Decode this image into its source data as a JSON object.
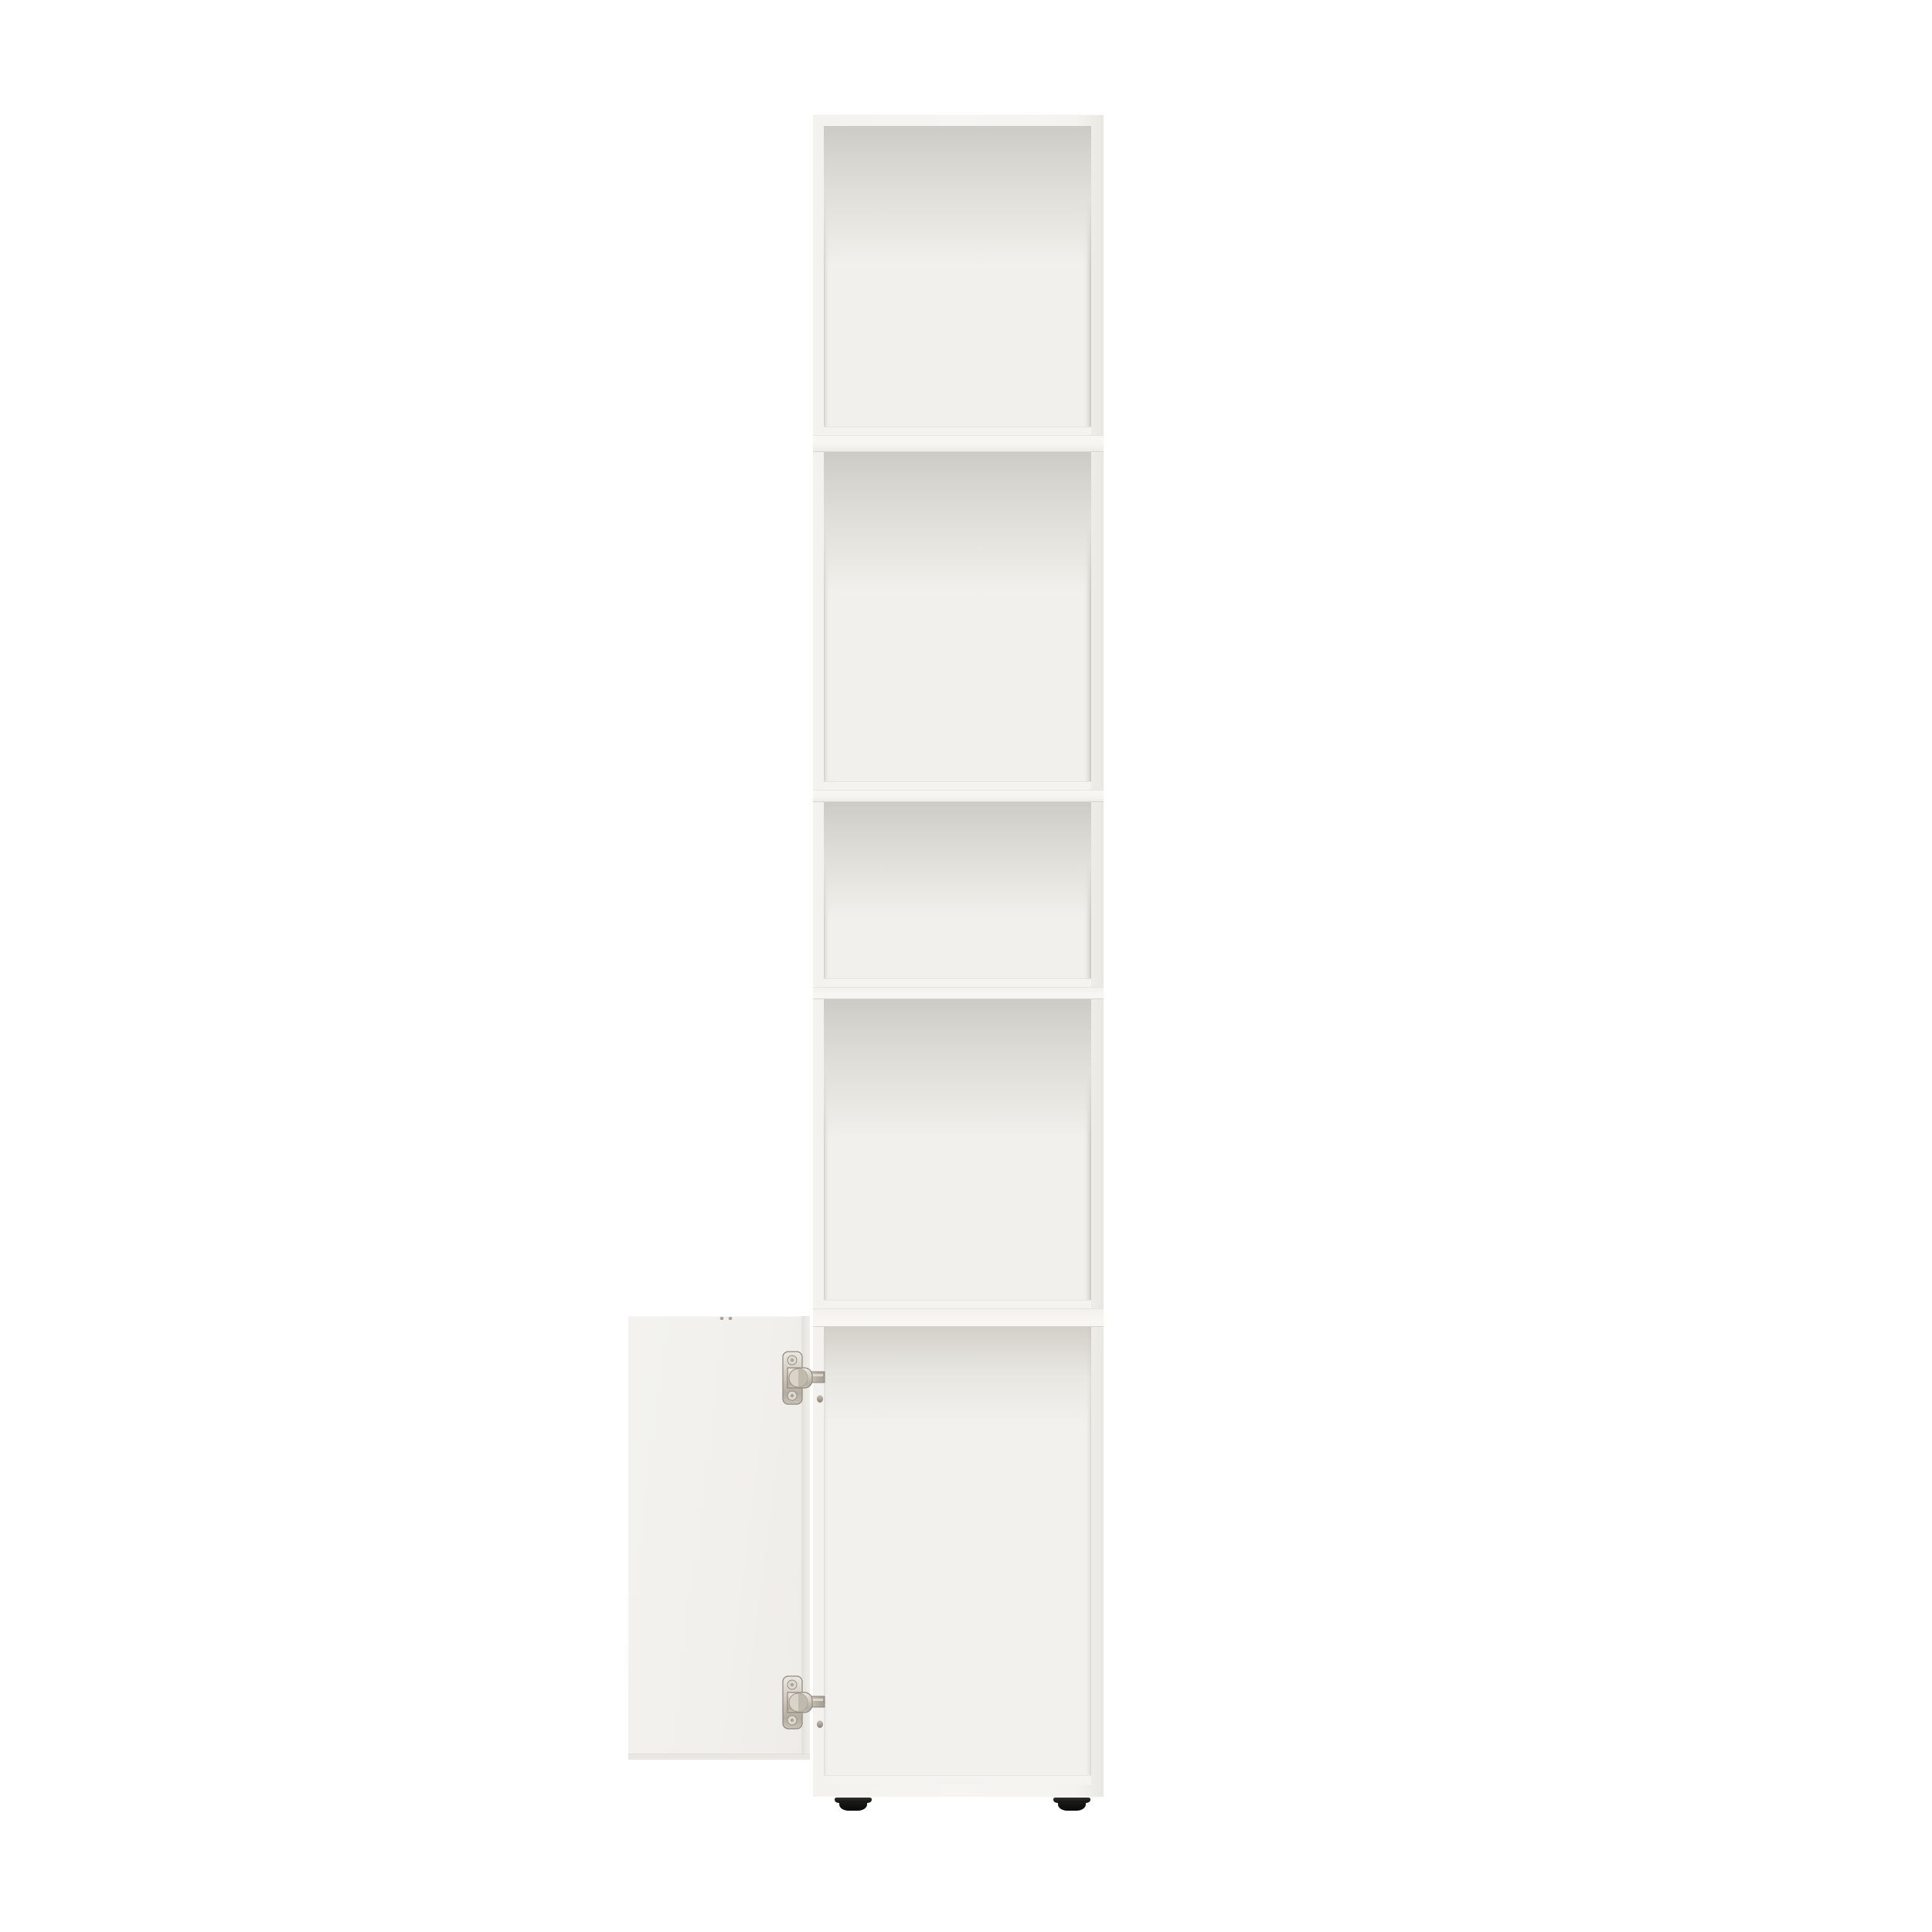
{
  "meta": {
    "subject": "Tall narrow white bookcase with four open compartments, an open bottom cabinet door with two nickel concealed hinges, standing on two black adjustable feet",
    "visible_text": "none"
  },
  "scene": {
    "background_color": "#ffffff"
  },
  "cabinet": {
    "finish": "matte white",
    "body_color": "#f5f4f1",
    "edge_shade_color": "#eae8e3",
    "interior_back_color": "#f1f0ec",
    "interior_shadow_color": "#cdcbc5",
    "open_compartment_count": 4,
    "divider_count": 3,
    "compartments": [
      {
        "label": "compartment-1",
        "relative_height": "tall"
      },
      {
        "label": "compartment-2",
        "relative_height": "tallest"
      },
      {
        "label": "compartment-3",
        "relative_height": "short"
      },
      {
        "label": "compartment-4",
        "relative_height": "tall"
      },
      {
        "label": "bottom-compartment",
        "relative_height": "tallest",
        "covered_by": "open door"
      }
    ]
  },
  "door": {
    "state": "open",
    "panel_color": "#f1f0ec",
    "edge_color": "#e7e5df",
    "hinges": {
      "count": 2,
      "type": "concealed cup hinge",
      "finish": "nickel",
      "metal_color": "#c6bfb4",
      "metal_highlight": "#ece8e1",
      "metal_shadow": "#8f887d"
    }
  },
  "feet": {
    "count": 2,
    "style": "round adjustable glide",
    "color": "#121211"
  }
}
